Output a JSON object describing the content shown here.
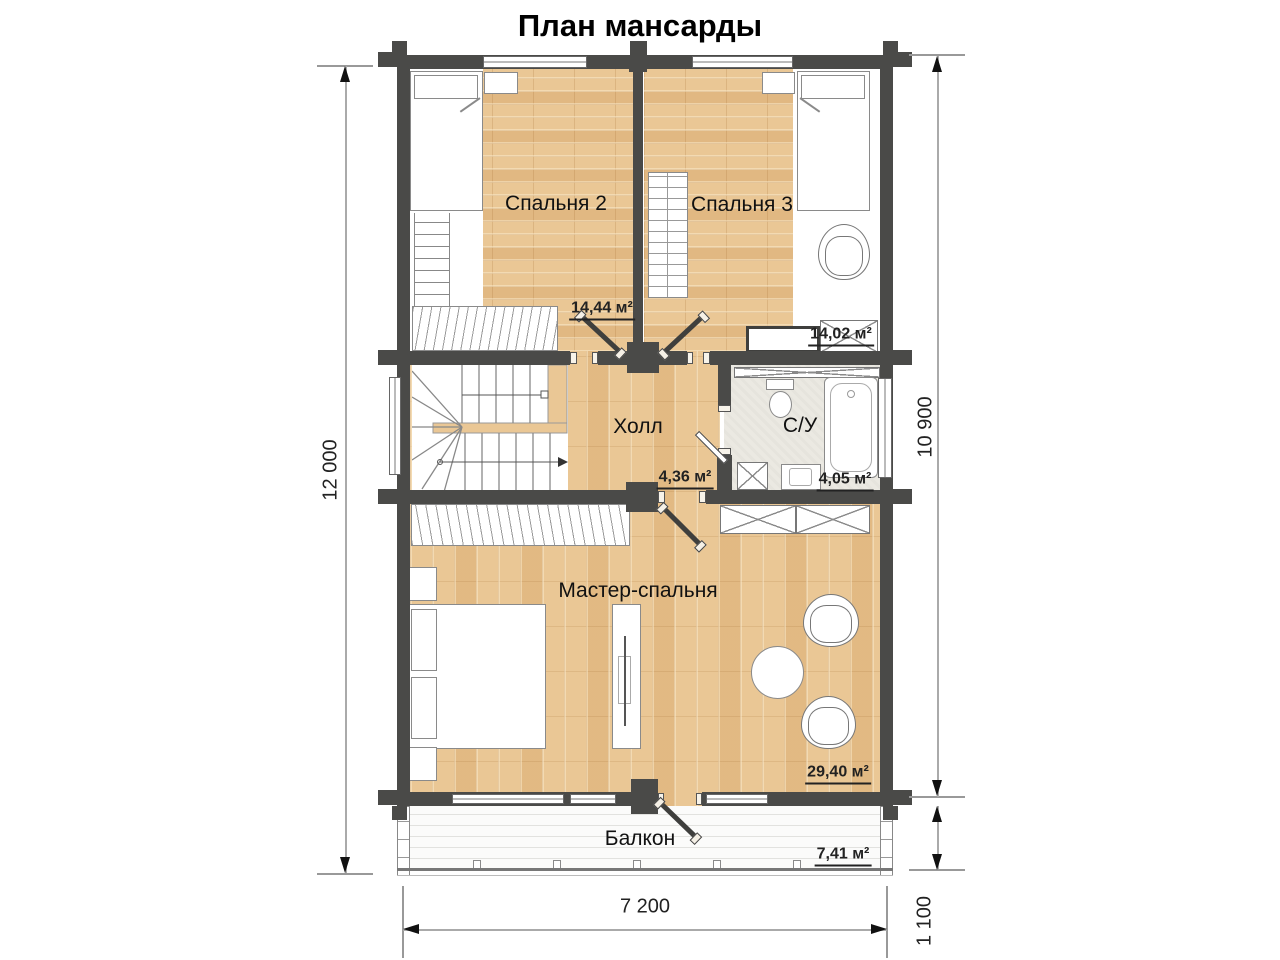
{
  "title": "План мансарды",
  "rooms": {
    "bedroom2": {
      "label": "Спальня 2",
      "area": "14,44 м²"
    },
    "bedroom3": {
      "label": "Спальня 3",
      "area": "14,02 м²"
    },
    "hall": {
      "label": "Холл",
      "area": "4,36 м²"
    },
    "bathroom": {
      "label": "С/У",
      "area": "4,05 м²"
    },
    "master": {
      "label": "Мастер-спальня",
      "area": "29,40 м²"
    },
    "balcony": {
      "label": "Балкон",
      "area": "7,41 м²"
    }
  },
  "dimensions": {
    "left": "12 000",
    "right_upper": "10 900",
    "right_lower": "1 100",
    "bottom": "7 200"
  },
  "colors": {
    "wall": "#4a4a48",
    "wood": "#eac795",
    "tile": "#ebe9e2"
  }
}
